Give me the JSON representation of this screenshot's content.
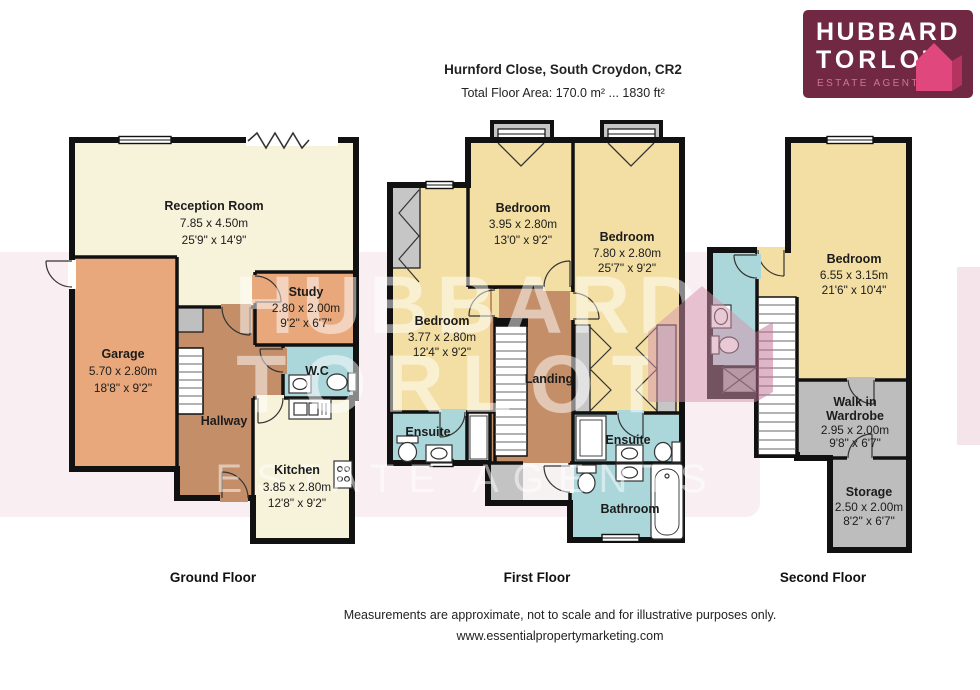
{
  "header": {
    "title": "Hurnford Close, South Croydon, CR2",
    "subtitle": "Total Floor Area: 170.0 m² ... 1830 ft²"
  },
  "logo": {
    "line1": "HUBBARD",
    "line2": "TORLOT",
    "tagline": "ESTATE AGENTS"
  },
  "watermark": {
    "line1": "HUBBARD",
    "line2": "TORLOT",
    "tagline": "ESTATE AGENTS"
  },
  "floors": [
    {
      "label": "Ground Floor",
      "rooms": [
        {
          "name": "Reception Room",
          "metric": "7.85 x 4.50m",
          "imperial": "25'9\" x 14'9\""
        },
        {
          "name": "Garage",
          "metric": "5.70 x 2.80m",
          "imperial": "18'8\" x 9'2\""
        },
        {
          "name": "Study",
          "metric": "2.80 x 2.00m",
          "imperial": "9'2\" x 6'7\""
        },
        {
          "name": "W.C"
        },
        {
          "name": "Hallway"
        },
        {
          "name": "Kitchen",
          "metric": "3.85 x 2.80m",
          "imperial": "12'8\" x 9'2\""
        }
      ]
    },
    {
      "label": "First Floor",
      "rooms": [
        {
          "name": "Bedroom",
          "metric": "3.95 x 2.80m",
          "imperial": "13'0\" x 9'2\""
        },
        {
          "name": "Bedroom",
          "metric": "7.80 x 2.80m",
          "imperial": "25'7\" x 9'2\""
        },
        {
          "name": "Bedroom",
          "metric": "3.77 x 2.80m",
          "imperial": "12'4\" x 9'2\""
        },
        {
          "name": "Ensuite"
        },
        {
          "name": "Landing"
        },
        {
          "name": "Ensuite"
        },
        {
          "name": "Bathroom"
        }
      ]
    },
    {
      "label": "Second Floor",
      "rooms": [
        {
          "name": "Bedroom",
          "metric": "6.55 x 3.15m",
          "imperial": "21'6\" x 10'4\""
        },
        {
          "name": "Walk in",
          "name2": "Wardrobe",
          "metric": "2.95 x 2.00m",
          "imperial": "9'8\" x 6'7\""
        },
        {
          "name": "Storage",
          "metric": "2.50 x 2.00m",
          "imperial": "8'2\" x 6'7\""
        }
      ]
    }
  ],
  "footer": {
    "line1": "Measurements are approximate, not to scale and for illustrative purposes only.",
    "line2": "www.essentialpropertymarketing.com"
  },
  "colors": {
    "plan_cream": "#f7f2da",
    "plan_orange": "#e8a87b",
    "plan_brown": "#c48f68",
    "plan_yellow": "#f3dfa3",
    "plan_blue": "#abd6da",
    "plan_gray": "#bdbdbd",
    "wall": "#111111",
    "logo_bg": "#702843",
    "logo_pink": "#e0477c"
  }
}
